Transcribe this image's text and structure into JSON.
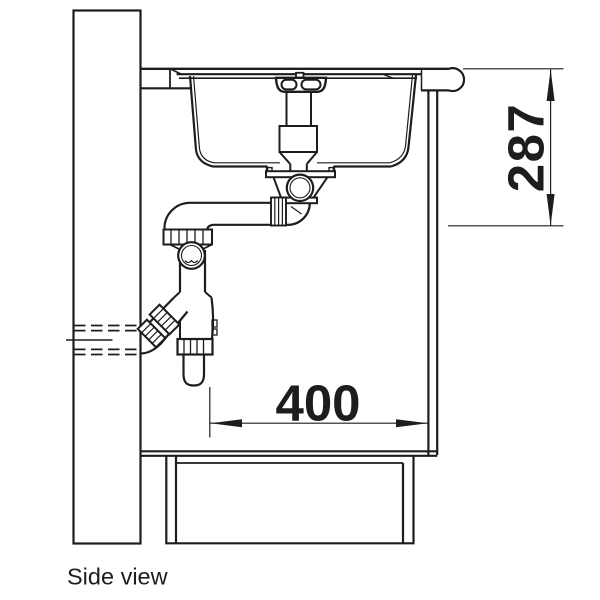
{
  "caption": "Side view",
  "dimensions": {
    "vertical": {
      "value": "287",
      "orientation": "vertical",
      "position": "right-of-cabinet"
    },
    "horizontal": {
      "value": "400",
      "orientation": "horizontal",
      "position": "inside-cabinet"
    }
  },
  "colors": {
    "line": "#1d1d1b",
    "background": "#ffffff"
  }
}
